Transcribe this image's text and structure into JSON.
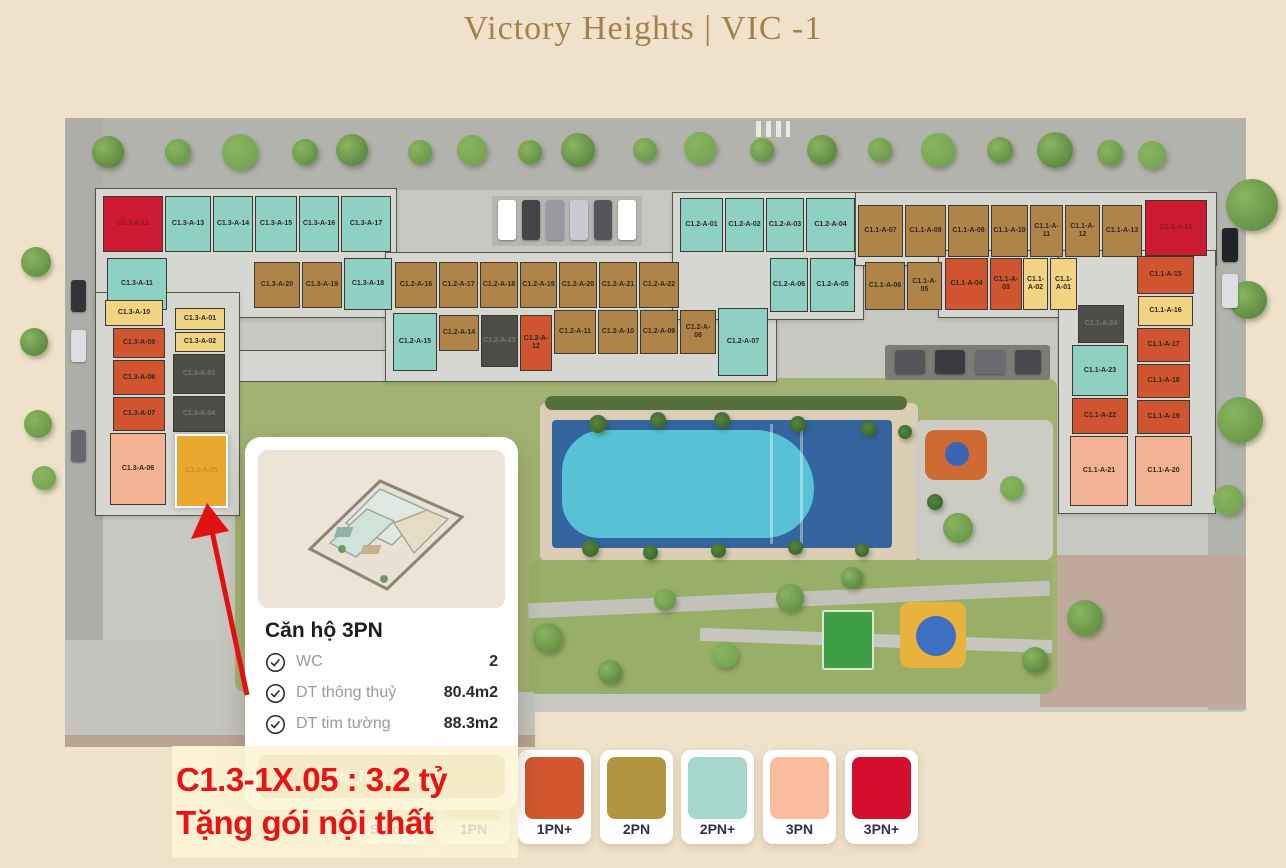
{
  "page": {
    "title": "Victory Heights | VIC -1"
  },
  "popup": {
    "title": "Căn hộ 3PN",
    "specs": [
      {
        "label": "WC",
        "value": "2"
      },
      {
        "label": "DT thông thuỷ",
        "value": "80.4m2"
      },
      {
        "label": "DT tim tường",
        "value": "88.3m2"
      }
    ],
    "cta_label": "Tìm hiểu thêm"
  },
  "promo": {
    "line1": "C1.3-1X.05 : 3.2 tỷ",
    "line2": "Tặng gói nội thất",
    "color": "#e81313"
  },
  "legend": {
    "items": [
      {
        "label": "Studio",
        "color": "#e3cf9a",
        "x": 355,
        "covered": true
      },
      {
        "label": "1PN",
        "color": "#f2d283",
        "x": 437,
        "covered": true
      },
      {
        "label": "1PN+",
        "color": "#d2572e",
        "x": 518
      },
      {
        "label": "2PN",
        "color": "#b3953f",
        "x": 600
      },
      {
        "label": "2PN+",
        "color": "#a7d7cb",
        "x": 681
      },
      {
        "label": "3PN",
        "color": "#f9bd9e",
        "x": 763
      },
      {
        "label": "3PN+",
        "color": "#d60e2d",
        "x": 845
      }
    ]
  },
  "map": {
    "selected_unit": "C1.3-A-05",
    "type_colors": {
      "1PN": "#f2d283",
      "1PN+": "#d0542f",
      "2PN": "#b08449",
      "2PN+": "#8ed0c2",
      "3PN": "#f2b293",
      "3PN+": "#cc1a32",
      "sold": "#4e4e49",
      "selected": "#e9a92e"
    },
    "units": [
      {
        "id": "C1.3-A-12",
        "type": "3PN+",
        "x": 103,
        "y": 196,
        "w": 60,
        "h": 56
      },
      {
        "id": "C1.3-A-13",
        "type": "2PN+",
        "x": 165,
        "y": 196,
        "w": 46,
        "h": 56
      },
      {
        "id": "C1.3-A-14",
        "type": "2PN+",
        "x": 213,
        "y": 196,
        "w": 40,
        "h": 56
      },
      {
        "id": "C1.3-A-15",
        "type": "2PN+",
        "x": 255,
        "y": 196,
        "w": 42,
        "h": 56
      },
      {
        "id": "C1.3-A-16",
        "type": "2PN+",
        "x": 299,
        "y": 196,
        "w": 40,
        "h": 56
      },
      {
        "id": "C1.3-A-17",
        "type": "2PN+",
        "x": 341,
        "y": 196,
        "w": 50,
        "h": 56
      },
      {
        "id": "C1.3-A-11",
        "type": "2PN+",
        "x": 107,
        "y": 258,
        "w": 60,
        "h": 52
      },
      {
        "id": "C1.3-A-20",
        "type": "2PN",
        "x": 254,
        "y": 262,
        "w": 46,
        "h": 46
      },
      {
        "id": "C1.3-A-19",
        "type": "2PN",
        "x": 302,
        "y": 262,
        "w": 40,
        "h": 46
      },
      {
        "id": "C1.3-A-18",
        "type": "2PN+",
        "x": 344,
        "y": 258,
        "w": 48,
        "h": 52
      },
      {
        "id": "C1.3-A-10",
        "type": "1PN",
        "x": 105,
        "y": 300,
        "w": 58,
        "h": 26
      },
      {
        "id": "C1.3-A-09",
        "type": "1PN+",
        "x": 113,
        "y": 328,
        "w": 52,
        "h": 30
      },
      {
        "id": "C1.3-A-08",
        "type": "1PN+",
        "x": 113,
        "y": 360,
        "w": 52,
        "h": 35
      },
      {
        "id": "C1.3-A-07",
        "type": "1PN+",
        "x": 113,
        "y": 397,
        "w": 52,
        "h": 34
      },
      {
        "id": "C1.3-A-06",
        "type": "3PN",
        "x": 110,
        "y": 433,
        "w": 56,
        "h": 72
      },
      {
        "id": "C1.3-A-01",
        "type": "1PN",
        "x": 175,
        "y": 308,
        "w": 50,
        "h": 22
      },
      {
        "id": "C1.3-A-02",
        "type": "1PN",
        "x": 175,
        "y": 332,
        "w": 50,
        "h": 20
      },
      {
        "id": "C1.3-A-03",
        "type": "sold",
        "x": 173,
        "y": 354,
        "w": 52,
        "h": 40
      },
      {
        "id": "C1.3-A-04",
        "type": "sold",
        "x": 173,
        "y": 396,
        "w": 52,
        "h": 36
      },
      {
        "id": "C1.3-A-05",
        "type": "selected",
        "x": 175,
        "y": 434,
        "w": 53,
        "h": 74
      },
      {
        "id": "C1.2-A-16",
        "type": "2PN",
        "x": 395,
        "y": 262,
        "w": 42,
        "h": 46
      },
      {
        "id": "C1.2-A-17",
        "type": "2PN",
        "x": 439,
        "y": 262,
        "w": 39,
        "h": 46
      },
      {
        "id": "C1.2-A-18",
        "type": "2PN",
        "x": 480,
        "y": 262,
        "w": 38,
        "h": 46
      },
      {
        "id": "C1.2-A-19",
        "type": "2PN",
        "x": 520,
        "y": 262,
        "w": 37,
        "h": 46
      },
      {
        "id": "C1.2-A-20",
        "type": "2PN",
        "x": 559,
        "y": 262,
        "w": 38,
        "h": 46
      },
      {
        "id": "C1.2-A-21",
        "type": "2PN",
        "x": 599,
        "y": 262,
        "w": 38,
        "h": 46
      },
      {
        "id": "C1.2-A-22",
        "type": "2PN",
        "x": 639,
        "y": 262,
        "w": 40,
        "h": 46
      },
      {
        "id": "C1.2-A-15",
        "type": "2PN+",
        "x": 393,
        "y": 313,
        "w": 44,
        "h": 58
      },
      {
        "id": "C1.2-A-14",
        "type": "2PN",
        "x": 439,
        "y": 315,
        "w": 40,
        "h": 36
      },
      {
        "id": "C1.2-A-13",
        "type": "sold",
        "x": 481,
        "y": 315,
        "w": 37,
        "h": 52
      },
      {
        "id": "C1.2-A-12",
        "type": "1PN+",
        "x": 520,
        "y": 315,
        "w": 32,
        "h": 56
      },
      {
        "id": "C1.2-A-11",
        "type": "2PN",
        "x": 554,
        "y": 310,
        "w": 42,
        "h": 44
      },
      {
        "id": "C1.2-A-10",
        "type": "2PN",
        "x": 598,
        "y": 310,
        "w": 40,
        "h": 44
      },
      {
        "id": "C1.2-A-09",
        "type": "2PN",
        "x": 640,
        "y": 310,
        "w": 38,
        "h": 44
      },
      {
        "id": "C1.2-A-08",
        "type": "2PN",
        "x": 680,
        "y": 310,
        "w": 36,
        "h": 44
      },
      {
        "id": "C1.2-A-07",
        "type": "2PN+",
        "x": 718,
        "y": 308,
        "w": 50,
        "h": 68
      },
      {
        "id": "C1.2-A-01",
        "type": "2PN+",
        "x": 680,
        "y": 198,
        "w": 43,
        "h": 54
      },
      {
        "id": "C1.2-A-02",
        "type": "2PN+",
        "x": 725,
        "y": 198,
        "w": 39,
        "h": 54
      },
      {
        "id": "C1.2-A-03",
        "type": "2PN+",
        "x": 766,
        "y": 198,
        "w": 38,
        "h": 54
      },
      {
        "id": "C1.2-A-04",
        "type": "2PN+",
        "x": 806,
        "y": 198,
        "w": 49,
        "h": 54
      },
      {
        "id": "C1.2-A-06",
        "type": "2PN+",
        "x": 770,
        "y": 258,
        "w": 38,
        "h": 54
      },
      {
        "id": "C1.2-A-05",
        "type": "2PN+",
        "x": 810,
        "y": 258,
        "w": 45,
        "h": 54
      },
      {
        "id": "C1.1-A-07",
        "type": "2PN",
        "x": 858,
        "y": 205,
        "w": 45,
        "h": 52
      },
      {
        "id": "C1.1-A-08",
        "type": "2PN",
        "x": 905,
        "y": 205,
        "w": 41,
        "h": 52
      },
      {
        "id": "C1.1-A-09",
        "type": "2PN",
        "x": 948,
        "y": 205,
        "w": 41,
        "h": 52
      },
      {
        "id": "C1.1-A-10",
        "type": "2PN",
        "x": 991,
        "y": 205,
        "w": 37,
        "h": 52
      },
      {
        "id": "C1.1-A-11",
        "type": "2PN",
        "x": 1030,
        "y": 205,
        "w": 33,
        "h": 52
      },
      {
        "id": "C1.1-A-12",
        "type": "2PN",
        "x": 1065,
        "y": 205,
        "w": 35,
        "h": 52
      },
      {
        "id": "C1.1-A-13",
        "type": "2PN",
        "x": 1102,
        "y": 205,
        "w": 40,
        "h": 52
      },
      {
        "id": "C1.1-A-14",
        "type": "3PN+",
        "x": 1145,
        "y": 200,
        "w": 62,
        "h": 56
      },
      {
        "id": "C1.1-A-06",
        "type": "2PN",
        "x": 865,
        "y": 262,
        "w": 40,
        "h": 48
      },
      {
        "id": "C1.1-A-05",
        "type": "2PN",
        "x": 907,
        "y": 262,
        "w": 35,
        "h": 48
      },
      {
        "id": "C1.1-A-04",
        "type": "1PN+",
        "x": 945,
        "y": 258,
        "w": 43,
        "h": 52
      },
      {
        "id": "C1.1-A-03",
        "type": "1PN+",
        "x": 990,
        "y": 258,
        "w": 32,
        "h": 52
      },
      {
        "id": "C1.1-A-02",
        "type": "1PN",
        "x": 1023,
        "y": 258,
        "w": 25,
        "h": 52
      },
      {
        "id": "C1.1-A-01",
        "type": "1PN",
        "x": 1050,
        "y": 258,
        "w": 27,
        "h": 52
      },
      {
        "id": "C1.1-A-15",
        "type": "1PN+",
        "x": 1137,
        "y": 256,
        "w": 57,
        "h": 38
      },
      {
        "id": "C1.1-A-16",
        "type": "1PN",
        "x": 1138,
        "y": 296,
        "w": 55,
        "h": 30
      },
      {
        "id": "C1.1-A-17",
        "type": "1PN+",
        "x": 1137,
        "y": 328,
        "w": 53,
        "h": 34
      },
      {
        "id": "C1.1-A-18",
        "type": "1PN+",
        "x": 1137,
        "y": 364,
        "w": 53,
        "h": 34
      },
      {
        "id": "C1.1-A-19",
        "type": "1PN+",
        "x": 1137,
        "y": 400,
        "w": 53,
        "h": 34
      },
      {
        "id": "C1.1-A-20",
        "type": "3PN",
        "x": 1135,
        "y": 436,
        "w": 57,
        "h": 70
      },
      {
        "id": "C1.1-A-24",
        "type": "sold",
        "x": 1078,
        "y": 305,
        "w": 46,
        "h": 38
      },
      {
        "id": "C1.1-A-23",
        "type": "2PN+",
        "x": 1072,
        "y": 345,
        "w": 56,
        "h": 51
      },
      {
        "id": "C1.1-A-22",
        "type": "1PN+",
        "x": 1072,
        "y": 398,
        "w": 56,
        "h": 36
      },
      {
        "id": "C1.1-A-21",
        "type": "3PN",
        "x": 1070,
        "y": 436,
        "w": 58,
        "h": 70
      }
    ]
  }
}
